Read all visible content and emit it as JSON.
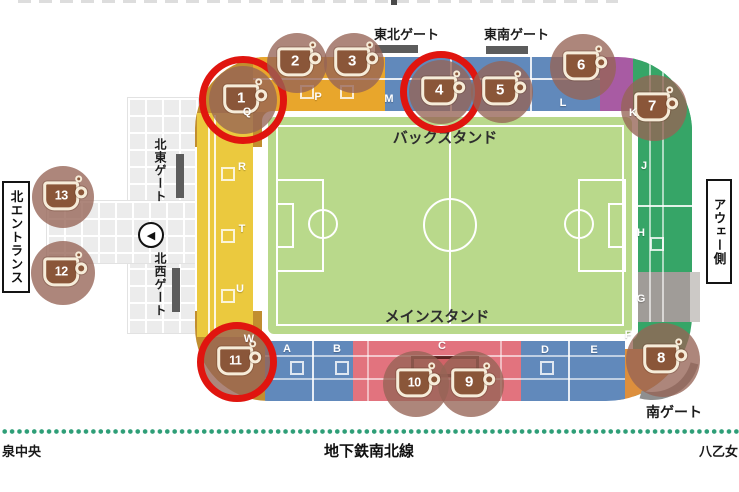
{
  "palette": {
    "left_stand_yellow": "#ebc93e",
    "corner_mustard": "#c18e2f",
    "top_stand_orange": "#e8a62c",
    "stand_blue": "#6189bb",
    "stand_purple": "#a85ba3",
    "stand_green": "#36a567",
    "stand_gray": "#a09c98",
    "stand_red": "#e2737e",
    "corner_orange": "#dd8f3d",
    "pitch_green": "#b9d98b",
    "stall_halo_brown": "#966456",
    "highlight_red": "#e0150f",
    "subway_green": "#2e9e77"
  },
  "gates": {
    "top_northeast": "東北ゲート",
    "top_southeast": "東南ゲート",
    "left_northeast": "北東ゲート",
    "left_northwest": "北西ゲート",
    "south": "南ゲート"
  },
  "labels": {
    "north_entrance": "北エントランス",
    "away_side": "アウェー側",
    "back_stand": "バックスタンド",
    "main_stand": "メインスタンド"
  },
  "subway": {
    "line_label": "地下鉄南北線",
    "station_left": "泉中央",
    "station_right": "八乙女"
  },
  "sections": [
    {
      "label": "P",
      "x": 318,
      "y": 97
    },
    {
      "label": "Q",
      "x": 247,
      "y": 112
    },
    {
      "label": "R",
      "x": 242,
      "y": 167
    },
    {
      "label": "T",
      "x": 242,
      "y": 229
    },
    {
      "label": "U",
      "x": 240,
      "y": 289
    },
    {
      "label": "W",
      "x": 249,
      "y": 339
    },
    {
      "label": "A",
      "x": 287,
      "y": 349
    },
    {
      "label": "B",
      "x": 337,
      "y": 349
    },
    {
      "label": "C",
      "x": 442,
      "y": 346
    },
    {
      "label": "D",
      "x": 545,
      "y": 350
    },
    {
      "label": "E",
      "x": 594,
      "y": 350
    },
    {
      "label": "F",
      "x": 628,
      "y": 335
    },
    {
      "label": "G",
      "x": 641,
      "y": 299
    },
    {
      "label": "H",
      "x": 641,
      "y": 233
    },
    {
      "label": "J",
      "x": 644,
      "y": 166
    },
    {
      "label": "K",
      "x": 633,
      "y": 113
    },
    {
      "label": "L",
      "x": 563,
      "y": 103
    },
    {
      "label": "M",
      "x": 389,
      "y": 99
    }
  ],
  "stalls": [
    {
      "number": "1",
      "x": 243,
      "y": 100,
      "halo_r": 34,
      "circled": true,
      "ring_r": 44
    },
    {
      "number": "2",
      "x": 297,
      "y": 63,
      "halo_r": 30,
      "circled": false
    },
    {
      "number": "3",
      "x": 354,
      "y": 63,
      "halo_r": 30,
      "circled": false
    },
    {
      "number": "4",
      "x": 441,
      "y": 92,
      "halo_r": 32,
      "circled": true,
      "ring_r": 41
    },
    {
      "number": "5",
      "x": 502,
      "y": 92,
      "halo_r": 31,
      "circled": false
    },
    {
      "number": "6",
      "x": 583,
      "y": 67,
      "halo_r": 33,
      "circled": false
    },
    {
      "number": "7",
      "x": 654,
      "y": 108,
      "halo_r": 33,
      "circled": false
    },
    {
      "number": "8",
      "x": 663,
      "y": 360,
      "halo_r": 37,
      "circled": false
    },
    {
      "number": "9",
      "x": 471,
      "y": 384,
      "halo_r": 33,
      "circled": false
    },
    {
      "number": "10",
      "x": 416,
      "y": 384,
      "halo_r": 33,
      "circled": false
    },
    {
      "number": "11",
      "x": 237,
      "y": 362,
      "halo_r": 37,
      "circled": true,
      "ring_r": 40
    },
    {
      "number": "12",
      "x": 63,
      "y": 273,
      "halo_r": 32,
      "circled": false
    },
    {
      "number": "13",
      "x": 63,
      "y": 197,
      "halo_r": 31,
      "circled": false
    }
  ]
}
